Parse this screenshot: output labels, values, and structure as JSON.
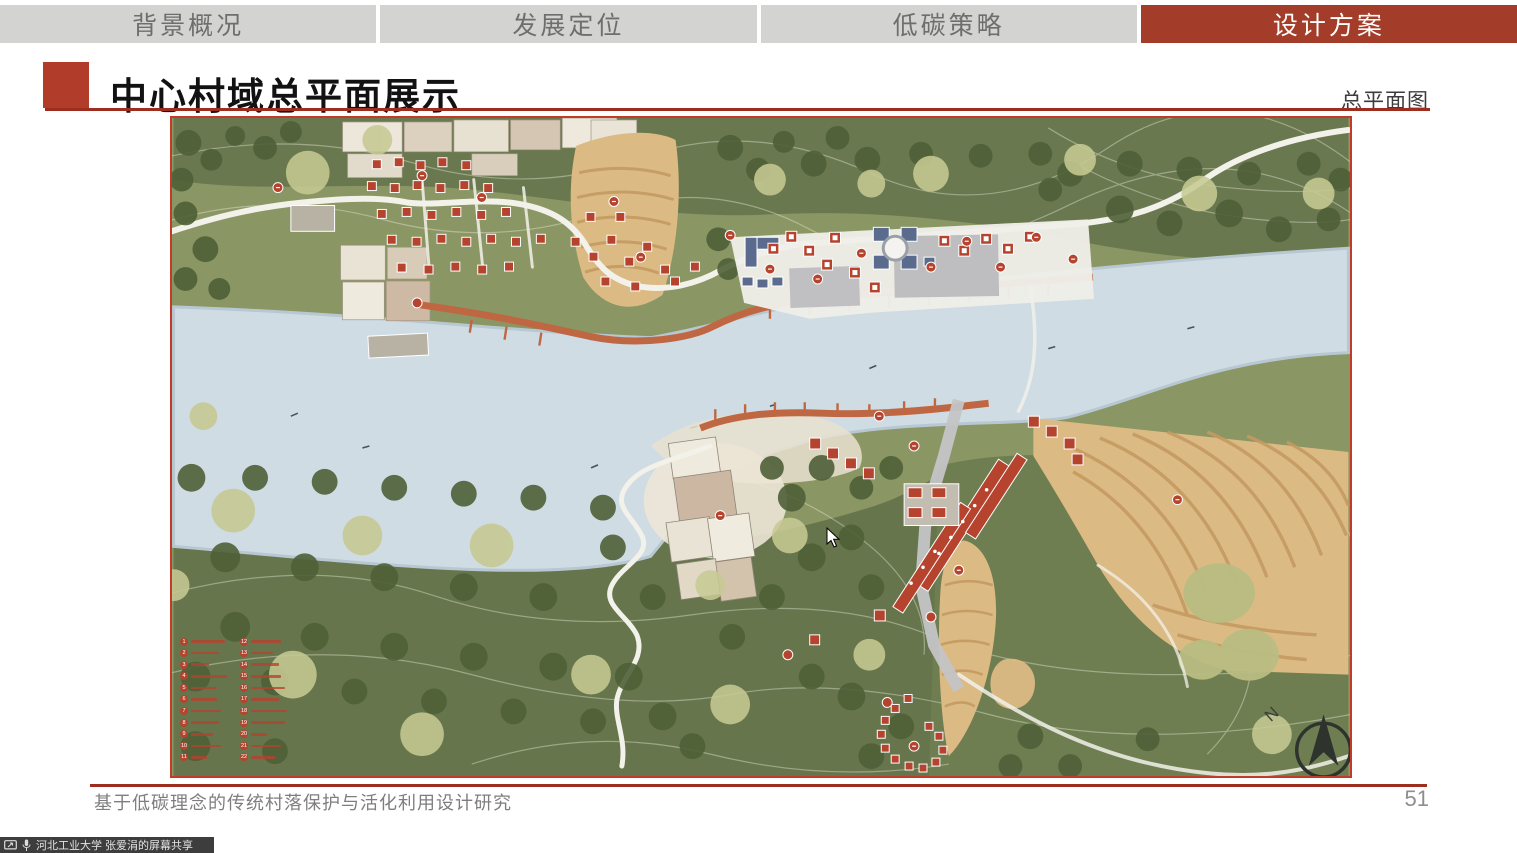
{
  "tabs": {
    "active_index": 3,
    "items": [
      {
        "label": "背景概况"
      },
      {
        "label": "发展定位"
      },
      {
        "label": "低碳策略"
      },
      {
        "label": "设计方案"
      }
    ]
  },
  "header": {
    "title": "中心村域总平面展示",
    "map_type_label": "总平面图"
  },
  "map": {
    "compass_label": "N",
    "legend": {
      "items": [
        {
          "number": "1"
        },
        {
          "number": "2"
        },
        {
          "number": "3"
        },
        {
          "number": "4"
        },
        {
          "number": "5"
        },
        {
          "number": "6"
        },
        {
          "number": "7"
        },
        {
          "number": "8"
        },
        {
          "number": "9"
        },
        {
          "number": "10"
        },
        {
          "number": "11"
        },
        {
          "number": "12"
        },
        {
          "number": "13"
        },
        {
          "number": "14"
        },
        {
          "number": "15"
        },
        {
          "number": "16"
        },
        {
          "number": "17"
        },
        {
          "number": "18"
        },
        {
          "number": "19"
        },
        {
          "number": "20"
        },
        {
          "number": "21"
        },
        {
          "number": "22"
        }
      ]
    }
  },
  "footer": {
    "project_title": "基于低碳理念的传统村落保护与活化利用设计研究",
    "page_number": "51"
  },
  "screenshare_bar": {
    "text": "河北工业大学 张爱涓的屏幕共享",
    "icons": [
      "screen-share-icon",
      "microphone-icon"
    ]
  },
  "colors": {
    "accent_red": "#A43C2A",
    "tab_inactive_bg": "#D3D3D1",
    "map_border": "#C23B28",
    "river": "#CFDCE4",
    "road_orange": "#BF6743",
    "building_red": "#B5432E",
    "building_blue": "#5A6B8E"
  }
}
